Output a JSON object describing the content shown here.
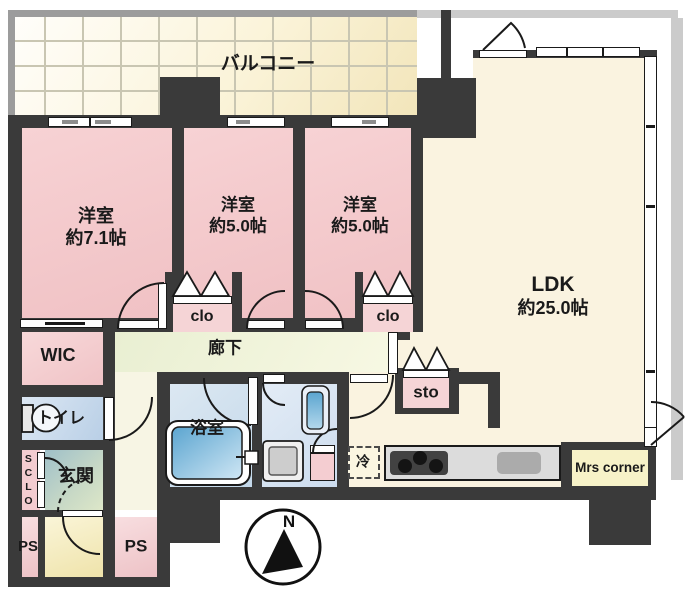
{
  "colors": {
    "wall": "#3a3a3a",
    "bedroom_pink": "#f2c6c8",
    "ldk_cream": "#faf3e0",
    "corridor_green": "#edf2d8",
    "bath_blue": "#cfe0ee",
    "balcony_yellow": "#f6ecc4",
    "shadow_gray": "#cbcbcb",
    "mrs_yellow": "#f7f2c8"
  },
  "compass": {
    "north": "N"
  },
  "balcony": {
    "label": "バルコニー"
  },
  "rooms": {
    "bedroom1": {
      "name": "洋室",
      "size": "約7.1帖"
    },
    "bedroom2": {
      "name": "洋室",
      "size": "約5.0帖"
    },
    "bedroom3": {
      "name": "洋室",
      "size": "約5.0帖"
    },
    "ldk": {
      "name": "LDK",
      "size": "約25.0帖"
    },
    "corridor": {
      "label": "廊下"
    },
    "wic": {
      "label": "WIC"
    },
    "toilet": {
      "label": "トイレ"
    },
    "shoes_closet": {
      "label": "SCLO"
    },
    "entrance": {
      "label": "玄関"
    },
    "bath": {
      "label": "浴室"
    },
    "closet2": {
      "label": "clo"
    },
    "closet3": {
      "label": "clo"
    },
    "storage": {
      "label": "sto"
    },
    "fridge": {
      "label": "冷"
    },
    "mrs_corner": {
      "label": "Mrs corner"
    },
    "ps_left": {
      "label": "PS"
    },
    "ps_right": {
      "label": "PS"
    }
  }
}
